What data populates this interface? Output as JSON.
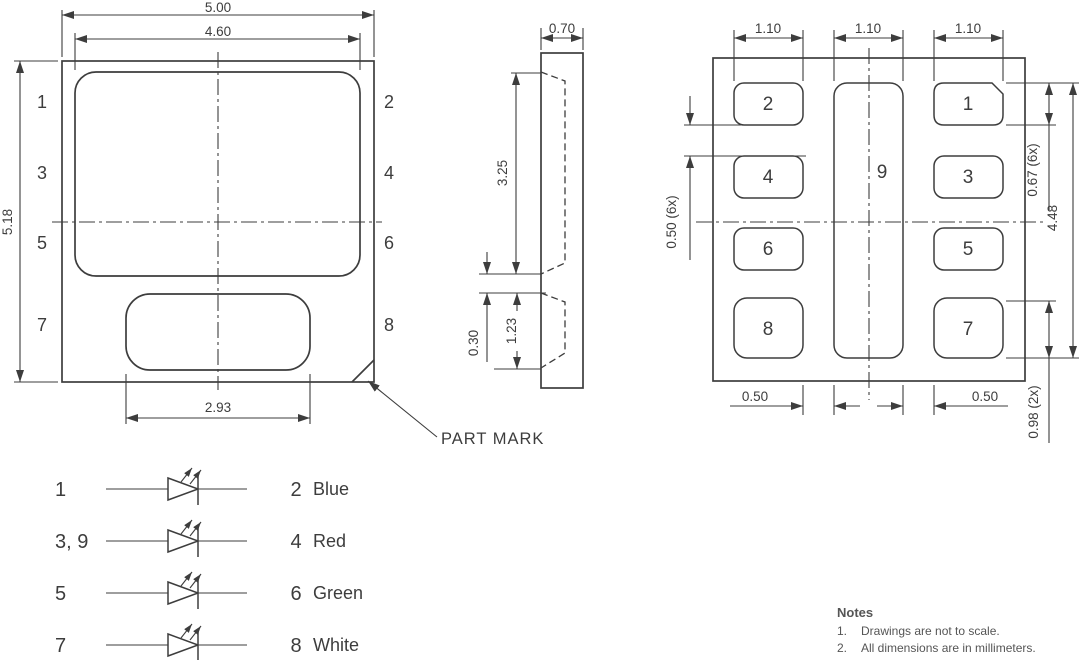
{
  "front_view": {
    "dimensions": {
      "outer_width": "5.00",
      "inner_width": "4.60",
      "outer_height": "5.18",
      "bottom_pad_width": "2.93"
    },
    "left_pins": [
      "1",
      "3",
      "5",
      "7"
    ],
    "right_pins": [
      "2",
      "4",
      "6",
      "8"
    ],
    "part_mark_label": "PART MARK"
  },
  "side_view": {
    "dimensions": {
      "thickness": "0.70",
      "upper_cavity_height": "3.25",
      "web_thickness": "0.30",
      "lower_cavity_height": "1.23"
    }
  },
  "bottom_view": {
    "dimensions": {
      "pad_widths": [
        "1.10",
        "1.10",
        "1.10"
      ],
      "pad_gap_vertical": "0.50 (6x)",
      "pad_height": "0.67 (6x)",
      "pad_span": "4.48",
      "corner_pad_height": "0.98 (2x)",
      "pad_gaps_horizontal": [
        "0.50",
        "0.50"
      ]
    },
    "pad_labels": [
      "1",
      "2",
      "3",
      "4",
      "5",
      "6",
      "7",
      "8",
      "9"
    ]
  },
  "legend": {
    "rows": [
      {
        "anode": "1",
        "cathode": "2",
        "color_name": "Blue"
      },
      {
        "anode": "3, 9",
        "cathode": "4",
        "color_name": "Red"
      },
      {
        "anode": "5",
        "cathode": "6",
        "color_name": "Green"
      },
      {
        "anode": "7",
        "cathode": "8",
        "color_name": "White"
      }
    ]
  },
  "notes": {
    "title": "Notes",
    "items": [
      {
        "num": "1.",
        "text": "Drawings are not to scale."
      },
      {
        "num": "2.",
        "text": "All dimensions are in millimeters."
      }
    ]
  },
  "colors": {
    "line": "#3d3d3d",
    "text": "#3d3d3d",
    "notes_text": "#555555",
    "background": "#ffffff"
  }
}
